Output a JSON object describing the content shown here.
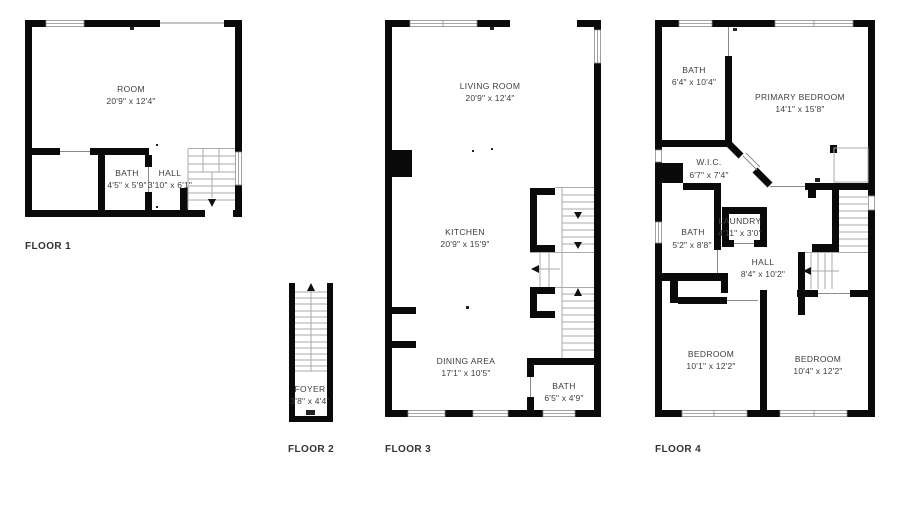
{
  "canvas": {
    "width": 900,
    "height": 529,
    "background": "#ffffff"
  },
  "colors": {
    "wall": "#0a0a0a",
    "stair_lines": "#aaaaaa",
    "window_frame": "#8a8a8a",
    "room_text": "#3d3d3d",
    "floor_label_text": "#333333"
  },
  "floors": [
    {
      "label": "FLOOR 1",
      "rooms": [
        {
          "name": "ROOM",
          "dims": "20'9\" x 12'4\""
        },
        {
          "name": "BATH",
          "dims": "4'5\" x 5'9\""
        },
        {
          "name": "HALL",
          "dims": "3'10\" x 6'1\""
        }
      ]
    },
    {
      "label": "FLOOR 2",
      "rooms": [
        {
          "name": "FOYER",
          "dims": "3'8\" x 4'4\""
        }
      ]
    },
    {
      "label": "FLOOR 3",
      "rooms": [
        {
          "name": "LIVING ROOM",
          "dims": "20'9\" x 12'4\""
        },
        {
          "name": "KITCHEN",
          "dims": "20'9\" x 15'9\""
        },
        {
          "name": "DINING AREA",
          "dims": "17'1\" x 10'5\""
        },
        {
          "name": "BATH",
          "dims": "6'5\" x 4'9\""
        }
      ]
    },
    {
      "label": "FLOOR 4",
      "rooms": [
        {
          "name": "BATH",
          "dims": "6'4\" x 10'4\""
        },
        {
          "name": "PRIMARY BEDROOM",
          "dims": "14'1\" x 15'8\""
        },
        {
          "name": "W.I.C.",
          "dims": "6'7\" x 7'4\""
        },
        {
          "name": "BATH",
          "dims": "5'2\" x 8'8\""
        },
        {
          "name": "LAUNDRY",
          "dims": "4'11\" x 3'0\""
        },
        {
          "name": "HALL",
          "dims": "8'4\" x 10'2\""
        },
        {
          "name": "BEDROOM",
          "dims": "10'1\" x 12'2\""
        },
        {
          "name": "BEDROOM",
          "dims": "10'4\" x 12'2\""
        }
      ]
    }
  ]
}
